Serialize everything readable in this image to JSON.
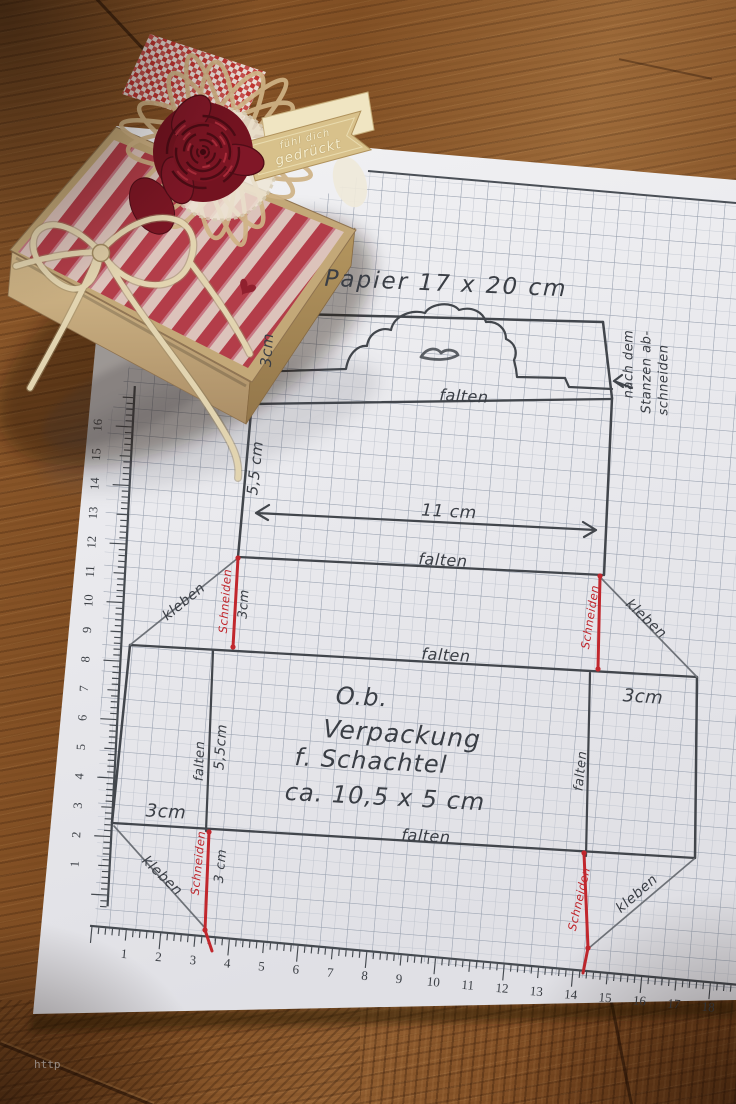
{
  "sheet": {
    "heading": "Papier 17 x 20 cm",
    "flap_height": "3cm",
    "fold_label": "falten",
    "glue_label": "kleben",
    "cut_label": "Schneiden",
    "note_line1": "nach dem",
    "note_line2": "Stanzen ab-",
    "note_line3": "schneiden",
    "strip_height": "5,5 cm",
    "strip_width": "11 cm",
    "tab_height_top": "3cm",
    "tab_height_bottom": "3 cm",
    "panel_width_right": "3cm",
    "panel_width_left": "3cm",
    "inner_height": "5,5cm",
    "title_line1": "O.b.",
    "title_line2": "Verpackung",
    "title_line3": "f. Schachtel",
    "title_line4": "ca. 10,5 x 5 cm",
    "ruler_bottom": [
      "1",
      "2",
      "3",
      "4",
      "5",
      "6",
      "7",
      "8",
      "9",
      "10",
      "11",
      "12",
      "13",
      "14",
      "15",
      "16",
      "17",
      "18"
    ],
    "ruler_left": [
      "1",
      "2",
      "3",
      "4",
      "5",
      "6",
      "7",
      "8",
      "9",
      "10",
      "11",
      "12",
      "13",
      "14",
      "15",
      "16"
    ]
  },
  "gift_box": {
    "banner_line1": "fühl dich",
    "banner_line2": "gedrückt"
  },
  "watermark": "http",
  "colors": {
    "ink": "#42464c",
    "red_pen": "#c1272d",
    "paper": "#ebebee",
    "grid_minor": "#b9bfca",
    "grid_major": "#9aa2b0",
    "kraft": "#c3a878",
    "stripe_red": "#b23a48",
    "rose": "#7c1523",
    "twine": "#e2d4b0",
    "wood": "#82502a"
  }
}
